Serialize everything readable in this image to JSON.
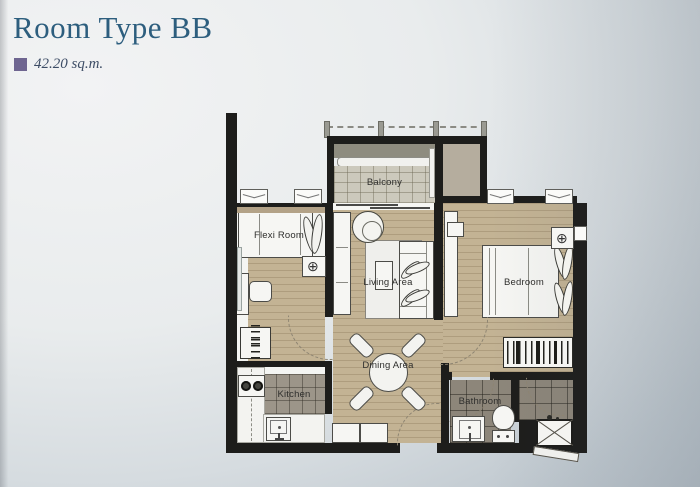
{
  "header": {
    "title": "Room Type BB",
    "area": "42.20 sq.m.",
    "bullet_color": "#6e6590",
    "title_color": "#2d5e7e"
  },
  "plan": {
    "labels": {
      "balcony": "Balcony",
      "flexi": "Flexi Room",
      "living": "Living Area",
      "bedroom": "Bedroom",
      "dining": "Dining Area",
      "kitchen": "Kitchen",
      "bathroom": "Bathroom"
    },
    "fixture_glyph": "⊕",
    "colors": {
      "wall": "#1d1d1b",
      "wood_floor": "#c3b394",
      "balcony_tile": "#ccc9bc",
      "kitchen_tile": "#9c9589",
      "bath_tile": "#8d867a",
      "ac_ledge": "#b5ad9e",
      "planter": "#8e8c7f"
    }
  }
}
